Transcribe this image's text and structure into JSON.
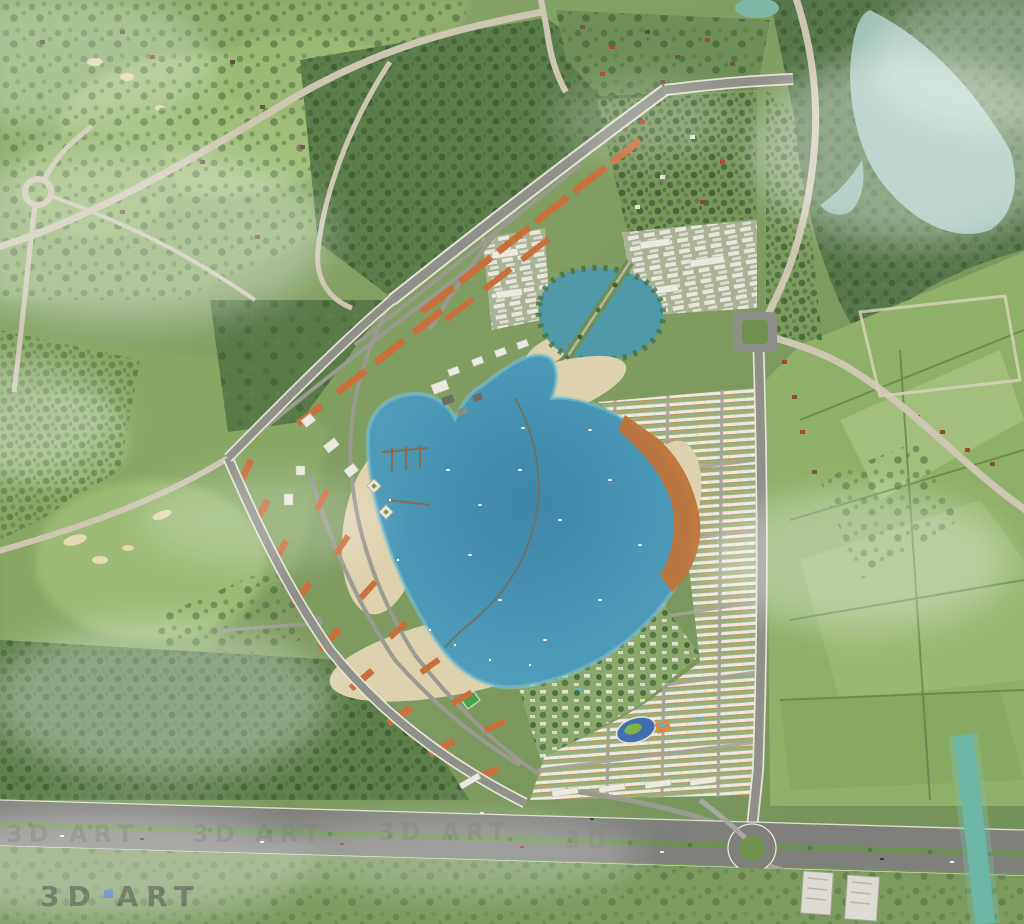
{
  "scene": {
    "type": "aerial-3d-masterplan-render",
    "description": "Bird's-eye 3D rendering of a lakeside township master plan surrounded by golf course, forest and farmland"
  },
  "watermark": {
    "text": "3D ART"
  },
  "palette": {
    "terrain_base": "#7e9b60",
    "field_light": "#8fb068",
    "field_pale": "#a5c07f",
    "forest_green": "#547747",
    "golf_fairway": "#a3c07b",
    "bunker_sand": "#e3d9b3",
    "lagoon_blue": "#4f9cba",
    "lagoon_deep": "#3d86a8",
    "round_lake_teal": "#4f99a8",
    "forest_lake_teal": "#9cc2b4",
    "river_teal": "#62b1a0",
    "beach_sand": "#ded2ae",
    "boardwalk_orange": "#bf7339",
    "roof_orange": "#c96f3c",
    "roof_red": "#a84a32",
    "roof_white": "#eceadf",
    "road_rural": "#cdc7b2",
    "road_urban": "#90918a",
    "highway_asphalt": "#7f807c",
    "median_green": "#6f8f55",
    "roundabout_green": "#6f934f",
    "clubhouse_blue": "#3f6fae",
    "court_green": "#49a24a",
    "pool_blue": "#58b7d8",
    "watermark_dark": "#4a4a48",
    "watermark_light": "#7d7d79"
  }
}
